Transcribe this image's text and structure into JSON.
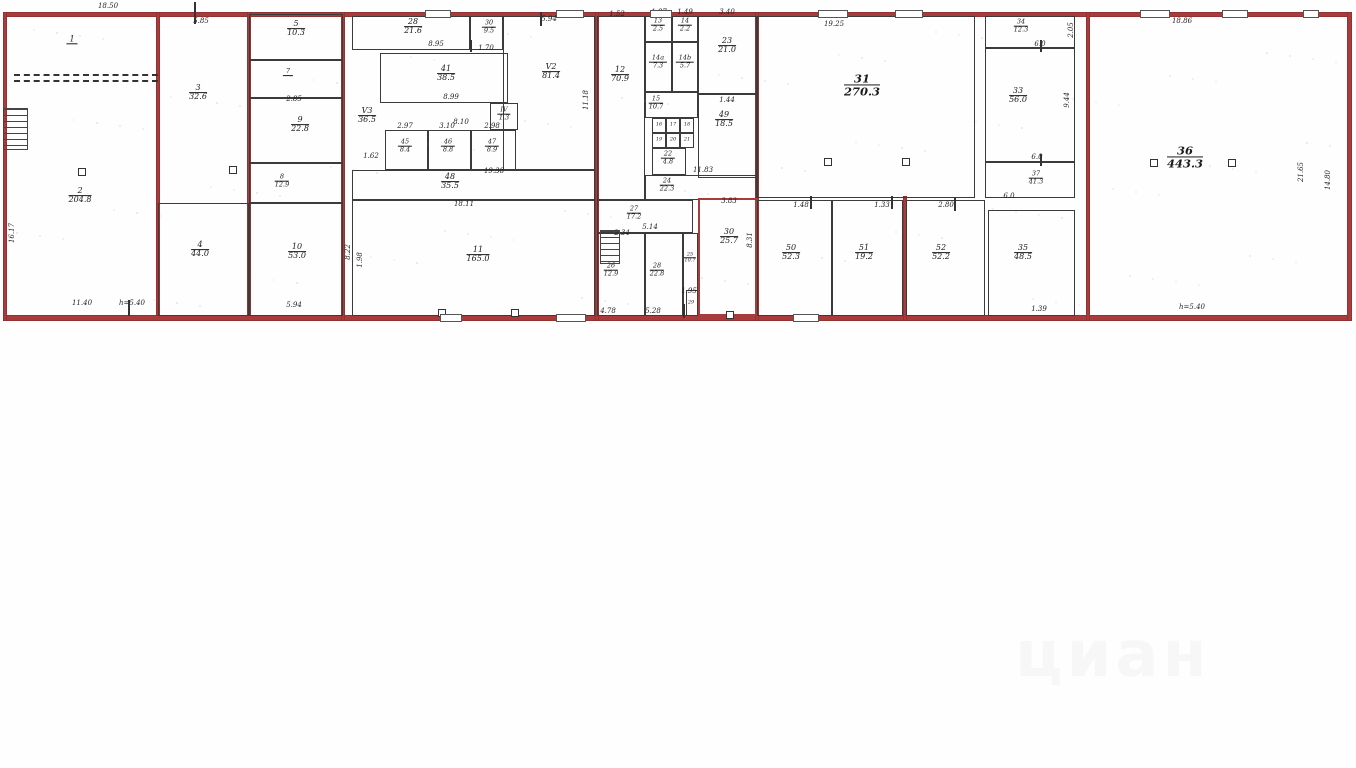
{
  "watermark": {
    "text": "циан"
  },
  "colors": {
    "wall_red": "#a83c3c",
    "wall_dark": "#3b3b3b",
    "paper": "#fefefe"
  },
  "plan": {
    "width": 1356,
    "height": 330,
    "walls_red": [
      [
        5,
        12,
        1345,
        5
      ],
      [
        5,
        315,
        1345,
        6
      ],
      [
        3,
        12,
        4,
        309
      ],
      [
        1347,
        12,
        5,
        309
      ],
      [
        156,
        12,
        4,
        304
      ],
      [
        247,
        12,
        4,
        304
      ],
      [
        341,
        12,
        4,
        309
      ],
      [
        595,
        12,
        4,
        309
      ],
      [
        755,
        12,
        4,
        309
      ],
      [
        903,
        196,
        4,
        125
      ],
      [
        1086,
        12,
        4,
        309
      ]
    ],
    "rooms": [
      {
        "num": "1",
        "area": "",
        "x": 5,
        "y": 14,
        "w": 153,
        "h": 63,
        "lx": 72,
        "ly": 40,
        "outline": "none",
        "size": ""
      },
      {
        "num": "2",
        "area": "204.8",
        "x": 5,
        "y": 77,
        "w": 153,
        "h": 239,
        "lx": 80,
        "ly": 196,
        "outline": "none",
        "size": ""
      },
      {
        "num": "3",
        "area": "32.6",
        "x": 158,
        "y": 14,
        "w": 91,
        "h": 189,
        "lx": 198,
        "ly": 93,
        "outline": "none",
        "size": ""
      },
      {
        "num": "4",
        "area": "44.0",
        "x": 158,
        "y": 203,
        "w": 91,
        "h": 113,
        "lx": 200,
        "ly": 250,
        "outline": "dark",
        "size": ""
      },
      {
        "num": "5",
        "area": "10.3",
        "x": 249,
        "y": 14,
        "w": 94,
        "h": 46,
        "lx": 296,
        "ly": 29,
        "outline": "dark",
        "size": ""
      },
      {
        "num": "7",
        "area": "",
        "x": 249,
        "y": 60,
        "w": 94,
        "h": 38,
        "lx": 288,
        "ly": 72,
        "outline": "dark",
        "size": "xs"
      },
      {
        "num": "9",
        "area": "22.8",
        "x": 249,
        "y": 98,
        "w": 94,
        "h": 65,
        "lx": 300,
        "ly": 125,
        "outline": "dark",
        "size": ""
      },
      {
        "num": "8",
        "area": "12.9",
        "x": 249,
        "y": 163,
        "w": 94,
        "h": 40,
        "lx": 282,
        "ly": 181,
        "outline": "dark",
        "size": "xs"
      },
      {
        "num": "10",
        "area": "53.0",
        "x": 249,
        "y": 203,
        "w": 94,
        "h": 113,
        "lx": 297,
        "ly": 252,
        "outline": "dark",
        "size": ""
      },
      {
        "num": "28",
        "area": "21.6",
        "x": 352,
        "y": 16,
        "w": 118,
        "h": 34,
        "lx": 413,
        "ly": 27,
        "outline": "dark",
        "size": ""
      },
      {
        "num": "30",
        "area": "9.5",
        "x": 470,
        "y": 16,
        "w": 33,
        "h": 34,
        "lx": 489,
        "ly": 27,
        "outline": "dark",
        "size": "xs"
      },
      {
        "num": "V2",
        "area": "81.4",
        "x": 503,
        "y": 16,
        "w": 92,
        "h": 154,
        "lx": 551,
        "ly": 72,
        "outline": "dark",
        "size": ""
      },
      {
        "num": "41",
        "area": "38.5",
        "x": 380,
        "y": 53,
        "w": 128,
        "h": 50,
        "lx": 446,
        "ly": 74,
        "outline": "dark",
        "size": ""
      },
      {
        "num": "V3",
        "area": "36.5",
        "x": 352,
        "y": 50,
        "w": 0,
        "h": 0,
        "lx": 367,
        "ly": 116,
        "outline": "none",
        "size": ""
      },
      {
        "num": "45",
        "area": "8.4",
        "x": 385,
        "y": 130,
        "w": 43,
        "h": 40,
        "lx": 405,
        "ly": 146,
        "outline": "dark",
        "size": "xs"
      },
      {
        "num": "46",
        "area": "8.8",
        "x": 428,
        "y": 130,
        "w": 43,
        "h": 40,
        "lx": 448,
        "ly": 146,
        "outline": "dark",
        "size": "xs"
      },
      {
        "num": "47",
        "area": "8.9",
        "x": 471,
        "y": 130,
        "w": 45,
        "h": 40,
        "lx": 492,
        "ly": 146,
        "outline": "dark",
        "size": "xs"
      },
      {
        "num": "IV",
        "area": "1.3",
        "x": 490,
        "y": 103,
        "w": 28,
        "h": 27,
        "lx": 504,
        "ly": 114,
        "outline": "dark",
        "size": "xs"
      },
      {
        "num": "48",
        "area": "35.5",
        "x": 352,
        "y": 170,
        "w": 243,
        "h": 30,
        "lx": 450,
        "ly": 182,
        "outline": "dark",
        "size": ""
      },
      {
        "num": "11",
        "area": "165.0",
        "x": 352,
        "y": 200,
        "w": 243,
        "h": 116,
        "lx": 478,
        "ly": 255,
        "outline": "dark",
        "size": ""
      },
      {
        "num": "12",
        "area": "70.9",
        "x": 597,
        "y": 16,
        "w": 48,
        "h": 184,
        "lx": 620,
        "ly": 75,
        "outline": "dark",
        "size": ""
      },
      {
        "num": "13",
        "area": "2.5",
        "x": 645,
        "y": 16,
        "w": 27,
        "h": 26,
        "lx": 658,
        "ly": 25,
        "outline": "dark",
        "size": "xs"
      },
      {
        "num": "14",
        "area": "2.2",
        "x": 672,
        "y": 16,
        "w": 26,
        "h": 26,
        "lx": 685,
        "ly": 25,
        "outline": "dark",
        "size": "xs"
      },
      {
        "num": "23",
        "area": "21.0",
        "x": 698,
        "y": 16,
        "w": 59,
        "h": 78,
        "lx": 727,
        "ly": 46,
        "outline": "dark",
        "size": ""
      },
      {
        "num": "14a",
        "area": "7.3",
        "x": 645,
        "y": 42,
        "w": 27,
        "h": 50,
        "lx": 658,
        "ly": 62,
        "outline": "dark",
        "size": "xs"
      },
      {
        "num": "14b",
        "area": "5.7",
        "x": 672,
        "y": 42,
        "w": 26,
        "h": 50,
        "lx": 685,
        "ly": 62,
        "outline": "dark",
        "size": "xs"
      },
      {
        "num": "15",
        "area": "10.7",
        "x": 645,
        "y": 92,
        "w": 53,
        "h": 26,
        "lx": 656,
        "ly": 103,
        "outline": "dark",
        "size": "xs"
      },
      {
        "num": "16",
        "area": "",
        "x": 652,
        "y": 118,
        "w": 14,
        "h": 15,
        "lx": 659,
        "ly": 125,
        "outline": "dark",
        "size": "xxs"
      },
      {
        "num": "17",
        "area": "",
        "x": 666,
        "y": 118,
        "w": 14,
        "h": 15,
        "lx": 673,
        "ly": 125,
        "outline": "dark",
        "size": "xxs"
      },
      {
        "num": "18",
        "area": "",
        "x": 680,
        "y": 118,
        "w": 14,
        "h": 15,
        "lx": 687,
        "ly": 125,
        "outline": "dark",
        "size": "xxs"
      },
      {
        "num": "19",
        "area": "",
        "x": 652,
        "y": 133,
        "w": 14,
        "h": 15,
        "lx": 659,
        "ly": 140,
        "outline": "dark",
        "size": "xxs"
      },
      {
        "num": "20",
        "area": "",
        "x": 666,
        "y": 133,
        "w": 14,
        "h": 15,
        "lx": 673,
        "ly": 140,
        "outline": "dark",
        "size": "xxs"
      },
      {
        "num": "21",
        "area": "",
        "x": 680,
        "y": 133,
        "w": 14,
        "h": 15,
        "lx": 687,
        "ly": 140,
        "outline": "dark",
        "size": "xxs"
      },
      {
        "num": "22",
        "area": "4.8",
        "x": 652,
        "y": 148,
        "w": 34,
        "h": 27,
        "lx": 668,
        "ly": 158,
        "outline": "dark",
        "size": "xs"
      },
      {
        "num": "49",
        "area": "18.5",
        "x": 698,
        "y": 94,
        "w": 59,
        "h": 84,
        "lx": 724,
        "ly": 120,
        "outline": "dark",
        "size": ""
      },
      {
        "num": "24",
        "area": "22.3",
        "x": 645,
        "y": 175,
        "w": 112,
        "h": 25,
        "lx": 667,
        "ly": 185,
        "outline": "dark",
        "size": "xs"
      },
      {
        "num": "27",
        "area": "17.2",
        "x": 597,
        "y": 200,
        "w": 96,
        "h": 33,
        "lx": 634,
        "ly": 213,
        "outline": "dark",
        "size": "xs"
      },
      {
        "num": "26",
        "area": "12.9",
        "x": 597,
        "y": 233,
        "w": 48,
        "h": 83,
        "lx": 611,
        "ly": 270,
        "outline": "dark",
        "size": "xs"
      },
      {
        "num": "28",
        "area": "22.8",
        "x": 645,
        "y": 233,
        "w": 38,
        "h": 83,
        "lx": 657,
        "ly": 270,
        "outline": "dark",
        "size": "xs"
      },
      {
        "num": "25",
        "area": "10.7",
        "x": 683,
        "y": 233,
        "w": 15,
        "h": 83,
        "lx": 690,
        "ly": 258,
        "outline": "dark",
        "size": "xxs"
      },
      {
        "num": "29",
        "area": "",
        "x": 686,
        "y": 290,
        "w": 12,
        "h": 26,
        "lx": 691,
        "ly": 303,
        "outline": "dark",
        "size": "xxs"
      },
      {
        "num": "30",
        "area": "25.7",
        "x": 698,
        "y": 198,
        "w": 59,
        "h": 118,
        "lx": 729,
        "ly": 237,
        "outline": "red",
        "size": ""
      },
      {
        "num": "31",
        "area": "270.3",
        "x": 757,
        "y": 16,
        "w": 218,
        "h": 182,
        "lx": 862,
        "ly": 85,
        "outline": "dark",
        "size": "l"
      },
      {
        "num": "50",
        "area": "52.3",
        "x": 757,
        "y": 200,
        "w": 75,
        "h": 116,
        "lx": 791,
        "ly": 253,
        "outline": "dark",
        "size": ""
      },
      {
        "num": "51",
        "area": "19.2",
        "x": 832,
        "y": 200,
        "w": 71,
        "h": 116,
        "lx": 864,
        "ly": 253,
        "outline": "dark",
        "size": ""
      },
      {
        "num": "52",
        "area": "52.2",
        "x": 906,
        "y": 200,
        "w": 79,
        "h": 116,
        "lx": 941,
        "ly": 253,
        "outline": "dark",
        "size": ""
      },
      {
        "num": "34",
        "area": "12.3",
        "x": 985,
        "y": 16,
        "w": 90,
        "h": 32,
        "lx": 1021,
        "ly": 26,
        "outline": "dark",
        "size": "xs"
      },
      {
        "num": "33",
        "area": "56.0",
        "x": 985,
        "y": 48,
        "w": 90,
        "h": 114,
        "lx": 1018,
        "ly": 96,
        "outline": "dark",
        "size": ""
      },
      {
        "num": "37",
        "area": "41.3",
        "x": 985,
        "y": 162,
        "w": 90,
        "h": 36,
        "lx": 1036,
        "ly": 178,
        "outline": "dark",
        "size": "xs"
      },
      {
        "num": "35",
        "area": "48.5",
        "x": 988,
        "y": 210,
        "w": 87,
        "h": 106,
        "lx": 1023,
        "ly": 253,
        "outline": "dark",
        "size": ""
      },
      {
        "num": "36",
        "area": "443.3",
        "x": 1088,
        "y": 16,
        "w": 262,
        "h": 300,
        "lx": 1185,
        "ly": 157,
        "outline": "none",
        "size": "l"
      }
    ],
    "dims": [
      {
        "t": "18.50",
        "x": 108,
        "y": 6
      },
      {
        "t": "5.85",
        "x": 201,
        "y": 21
      },
      {
        "t": "5.94",
        "x": 549,
        "y": 19
      },
      {
        "t": "2.85",
        "x": 294,
        "y": 99
      },
      {
        "t": "8.95",
        "x": 436,
        "y": 44
      },
      {
        "t": "1.70",
        "x": 486,
        "y": 48
      },
      {
        "t": "8.99",
        "x": 451,
        "y": 97
      },
      {
        "t": "8.10",
        "x": 461,
        "y": 122
      },
      {
        "t": "2.97",
        "x": 405,
        "y": 126
      },
      {
        "t": "3.10",
        "x": 447,
        "y": 126
      },
      {
        "t": "2.98",
        "x": 492,
        "y": 126
      },
      {
        "t": "1.62",
        "x": 371,
        "y": 156
      },
      {
        "t": "19.38",
        "x": 494,
        "y": 171
      },
      {
        "t": "18.11",
        "x": 464,
        "y": 204
      },
      {
        "t": "11.18",
        "x": 586,
        "y": 100,
        "v": 1
      },
      {
        "t": "8.22",
        "x": 348,
        "y": 252,
        "v": 1
      },
      {
        "t": "1.98",
        "x": 360,
        "y": 260,
        "v": 1
      },
      {
        "t": "1.52",
        "x": 617,
        "y": 14
      },
      {
        "t": "1.87",
        "x": 659,
        "y": 12
      },
      {
        "t": "1.49",
        "x": 685,
        "y": 12
      },
      {
        "t": "3.40",
        "x": 727,
        "y": 12
      },
      {
        "t": "1.44",
        "x": 727,
        "y": 100
      },
      {
        "t": "11.83",
        "x": 703,
        "y": 170
      },
      {
        "t": "5.14",
        "x": 650,
        "y": 227
      },
      {
        "t": "2.34",
        "x": 622,
        "y": 233
      },
      {
        "t": "4.78",
        "x": 608,
        "y": 311
      },
      {
        "t": "5.28",
        "x": 653,
        "y": 311
      },
      {
        "t": "1.95",
        "x": 689,
        "y": 291
      },
      {
        "t": "3.83",
        "x": 729,
        "y": 201
      },
      {
        "t": "8.31",
        "x": 750,
        "y": 240,
        "v": 1
      },
      {
        "t": "19.25",
        "x": 834,
        "y": 24
      },
      {
        "t": "1.48",
        "x": 801,
        "y": 205
      },
      {
        "t": "1.33",
        "x": 882,
        "y": 205
      },
      {
        "t": "2.80",
        "x": 946,
        "y": 205
      },
      {
        "t": "6.0",
        "x": 1040,
        "y": 44
      },
      {
        "t": "2.05",
        "x": 1071,
        "y": 30,
        "v": 1
      },
      {
        "t": "9.44",
        "x": 1067,
        "y": 100,
        "v": 1
      },
      {
        "t": "6.0",
        "x": 1037,
        "y": 157
      },
      {
        "t": "6.0",
        "x": 1009,
        "y": 196
      },
      {
        "t": "1.39",
        "x": 1039,
        "y": 309
      },
      {
        "t": "18.86",
        "x": 1182,
        "y": 21
      },
      {
        "t": "21.65",
        "x": 1301,
        "y": 172,
        "v": 1
      },
      {
        "t": "14.80",
        "x": 1328,
        "y": 180,
        "v": 1
      },
      {
        "t": "h=5.40",
        "x": 1192,
        "y": 307
      },
      {
        "t": "16.17",
        "x": 12,
        "y": 233,
        "v": 1
      },
      {
        "t": "11.40",
        "x": 82,
        "y": 303
      },
      {
        "t": "h=5.40",
        "x": 132,
        "y": 303
      },
      {
        "t": "5.94",
        "x": 294,
        "y": 305
      }
    ],
    "columns": [
      [
        78,
        168
      ],
      [
        229,
        166
      ],
      [
        824,
        158
      ],
      [
        902,
        158
      ],
      [
        1150,
        159
      ],
      [
        1228,
        159
      ],
      [
        438,
        309
      ],
      [
        511,
        309
      ],
      [
        726,
        311
      ]
    ],
    "openings": [
      [
        425,
        10,
        26
      ],
      [
        556,
        10,
        28
      ],
      [
        650,
        10,
        22
      ],
      [
        818,
        10,
        30
      ],
      [
        895,
        10,
        28
      ],
      [
        1140,
        10,
        30
      ],
      [
        1222,
        10,
        26
      ],
      [
        1303,
        10,
        16
      ],
      [
        556,
        314,
        30
      ],
      [
        793,
        314,
        26
      ],
      [
        440,
        314,
        22
      ]
    ],
    "ticks": [
      [
        194,
        2,
        22
      ],
      [
        540,
        12,
        14
      ],
      [
        470,
        40,
        12
      ],
      [
        128,
        300,
        16
      ],
      [
        683,
        304,
        14
      ],
      [
        810,
        196,
        13
      ],
      [
        891,
        196,
        13
      ],
      [
        954,
        198,
        13
      ],
      [
        1040,
        40,
        12
      ],
      [
        1040,
        154,
        12
      ]
    ],
    "stairs": [
      [
        3,
        108,
        25,
        42
      ],
      [
        600,
        230,
        20,
        34
      ]
    ],
    "dashed": [
      [
        14,
        74,
        144
      ]
    ]
  }
}
